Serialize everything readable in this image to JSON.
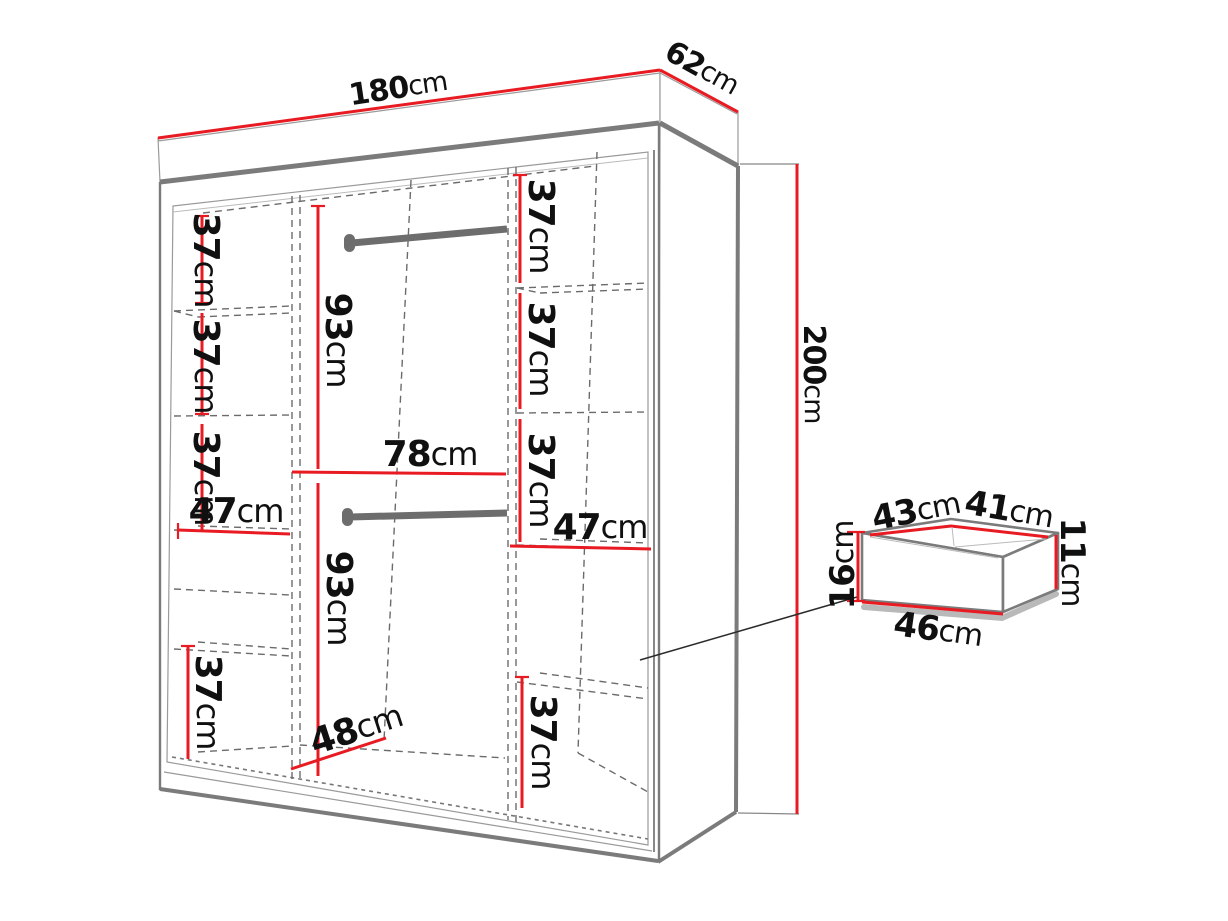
{
  "colors": {
    "dimension": "#e81b23",
    "outline": "#7b7b7b",
    "dashed": "#6b6b6b",
    "rail": "#6d6d6d",
    "leader": "#2b2b2b",
    "text": "#101010"
  },
  "dimensions": {
    "width": {
      "num": "180",
      "unit": "cm"
    },
    "depth": {
      "num": "62",
      "unit": "cm"
    },
    "height": {
      "num": "200",
      "unit": "cm"
    },
    "left_shelf_1": {
      "num": "37",
      "unit": "cm"
    },
    "left_shelf_2": {
      "num": "37",
      "unit": "cm"
    },
    "left_shelf_3": {
      "num": "37",
      "unit": "cm"
    },
    "left_width": {
      "num": "47",
      "unit": "cm"
    },
    "left_bottom": {
      "num": "37",
      "unit": "cm"
    },
    "mid_upper_hanging": {
      "num": "93",
      "unit": "cm"
    },
    "mid_width": {
      "num": "78",
      "unit": "cm"
    },
    "mid_lower_hanging": {
      "num": "93",
      "unit": "cm"
    },
    "inner_depth": {
      "num": "48",
      "unit": "cm"
    },
    "right_shelf_1": {
      "num": "37",
      "unit": "cm"
    },
    "right_shelf_2": {
      "num": "37",
      "unit": "cm"
    },
    "right_shelf_3": {
      "num": "37",
      "unit": "cm"
    },
    "right_width": {
      "num": "47",
      "unit": "cm"
    },
    "right_bottom": {
      "num": "37",
      "unit": "cm"
    },
    "drawer_front_height": {
      "num": "16",
      "unit": "cm"
    },
    "drawer_top_left": {
      "num": "43",
      "unit": "cm"
    },
    "drawer_top_right": {
      "num": "41",
      "unit": "cm"
    },
    "drawer_back_height": {
      "num": "11",
      "unit": "cm"
    },
    "drawer_front_width": {
      "num": "46",
      "unit": "cm"
    }
  }
}
